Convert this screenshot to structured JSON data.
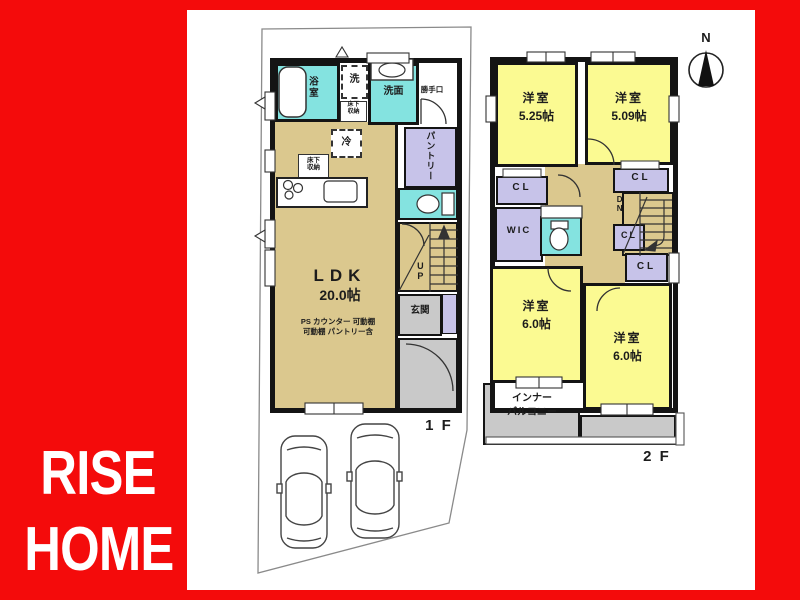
{
  "brand": {
    "line1": "RISE",
    "line2": "HOME"
  },
  "compass": {
    "north": "N"
  },
  "floor1": {
    "label": "1 F",
    "bath": "浴室",
    "laundry": "洗",
    "washroom": "洗面",
    "backdoor": "勝手口",
    "underfloor_storage1": "床下\n収納",
    "underfloor_storage2": "床下\n収納",
    "pantry": "パントリー",
    "fridge": "冷",
    "ldk_name": "LDK",
    "ldk_size": "20.0帖",
    "ldk_note1": "PS カウンター 可動棚",
    "ldk_note2": "可動棚 パントリー含",
    "entrance": "玄関",
    "stairs_up": "UP"
  },
  "floor2": {
    "label": "2 F",
    "bedroom1_name": "洋室",
    "bedroom1_size": "5.25帖",
    "bedroom2_name": "洋室",
    "bedroom2_size": "5.09帖",
    "bedroom3_name": "洋室",
    "bedroom3_size": "6.0帖",
    "bedroom4_name": "洋室",
    "bedroom4_size": "6.0帖",
    "closet1": "CL",
    "closet2": "CL",
    "closet3": "CL",
    "closet4": "CL",
    "wic": "WIC",
    "stairs_down": "DN",
    "balcony_line1": "インナー",
    "balcony_line2": "バルコニー"
  },
  "colors": {
    "background_red": "#f40b0b",
    "room_tan": "#dbc88e",
    "room_yellow": "#fbfa92",
    "water_cyan": "#84e3e0",
    "storage_purple": "#c7c3e9",
    "entry_gray": "#c9c9c9",
    "wall_black": "#141414",
    "brand_white": "#ffffff"
  }
}
